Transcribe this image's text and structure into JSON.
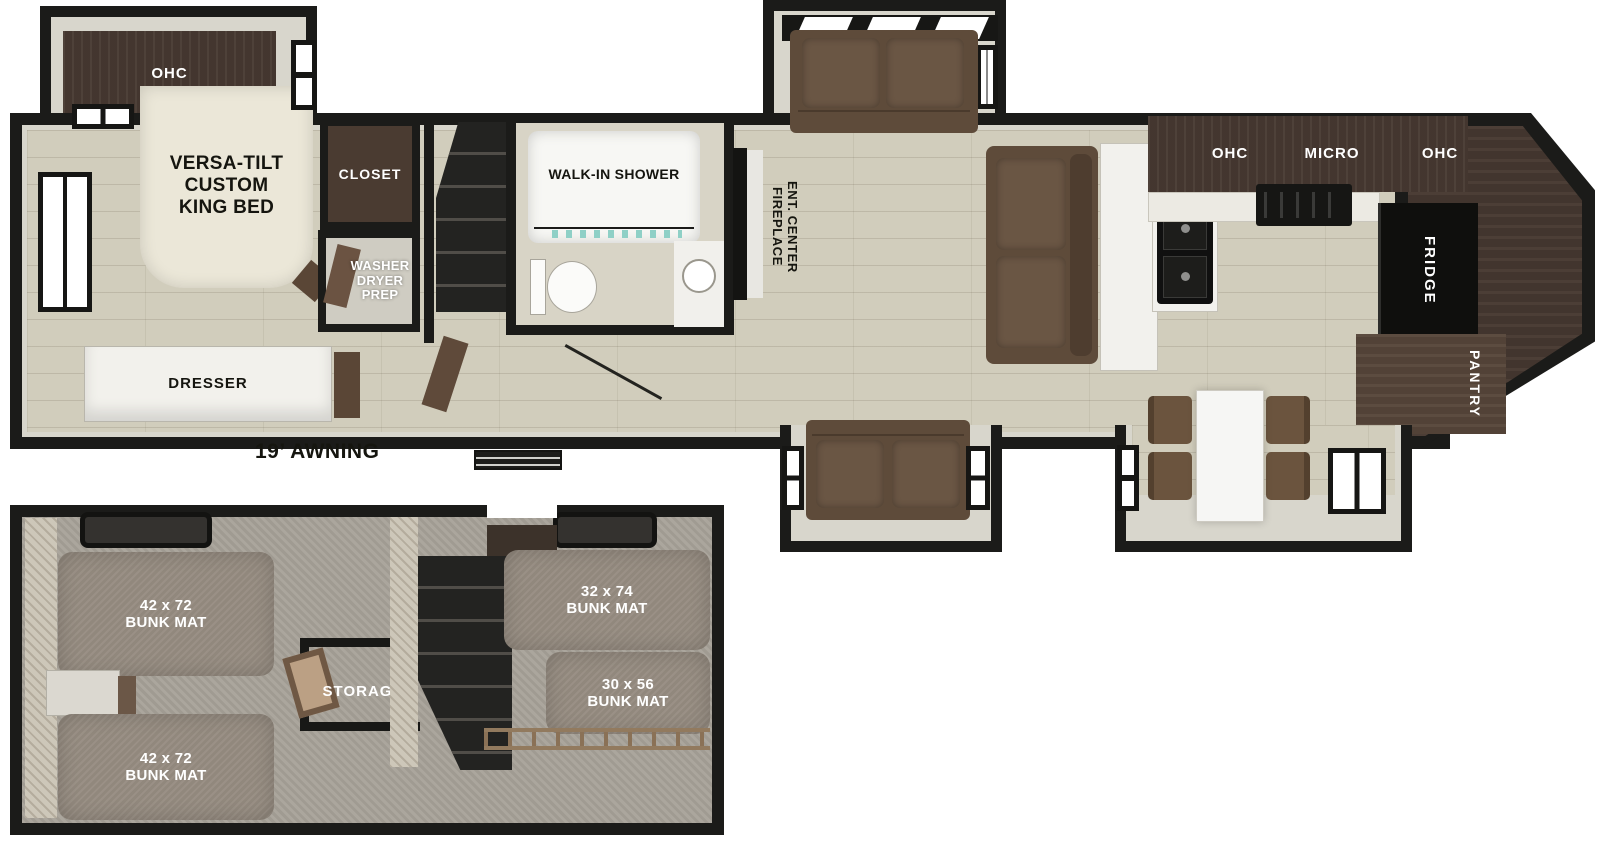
{
  "colors": {
    "wall": "#1b1b19",
    "wall_liner": "#d8d6cc",
    "wood_floor": "#d1cdbc",
    "carpet": "#a7a198",
    "cabinet_brown": "#473931",
    "sofa_brown": "#5e4b3a",
    "bed_cream": "#ebe7d8",
    "bunk_mat": "#968c81",
    "white_fixture": "#f4f3ef",
    "label_black": "#15150f",
    "label_white": "#ffffff"
  },
  "main_floor": {
    "awning_label": "19’ AWNING",
    "bedroom": {
      "ohc": "OHC",
      "bed": "VERSA-TILT\nCUSTOM\nKING BED",
      "closet": "CLOSET",
      "washer_dryer": "WASHER\nDRYER\nPREP",
      "dresser": "DRESSER"
    },
    "bathroom": {
      "shower": "WALK-IN SHOWER"
    },
    "living": {
      "ent_center": "ENT. CENTER\nFIREPLACE"
    },
    "kitchen": {
      "ohc_left": "OHC",
      "micro": "MICRO",
      "ohc_right": "OHC",
      "fridge": "FRIDGE",
      "pantry": "PANTRY"
    }
  },
  "bunk_room": {
    "bunk_top_left": "42 x 72\nBUNK MAT",
    "bunk_bottom_left": "42 x 72\nBUNK MAT",
    "bunk_top_right": "32 x 74\nBUNK MAT",
    "bunk_bottom_right": "30 x 56\nBUNK MAT",
    "storage": "STORAGE"
  }
}
